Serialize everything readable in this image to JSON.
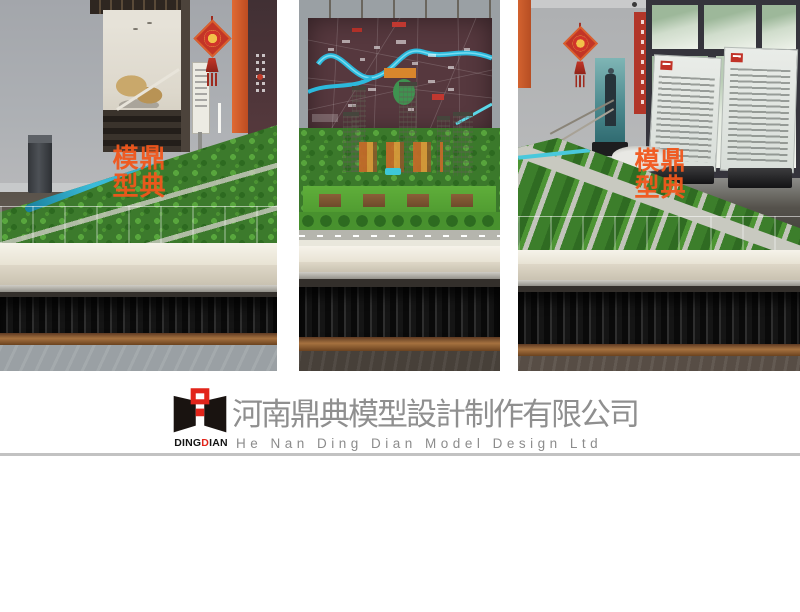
{
  "canvas": {
    "width": 800,
    "height": 612,
    "background": "#ffffff"
  },
  "branding": {
    "logo_word": {
      "part1": "DING",
      "accent": "D",
      "part2": "IAN"
    },
    "company_name_cn": "河南鼎典模型設計制作有限公司",
    "company_name_en": "He Nan Ding Dian Model Design Ltd",
    "accent_red": "#e2251b",
    "text_gray": "#8f8f8f",
    "divider_color": "#c2c2c2"
  },
  "watermark": {
    "color": "#f2571c",
    "chars": {
      "tl": "模",
      "tr": "鼎",
      "bl": "型",
      "br": "典"
    }
  },
  "photos": [
    {
      "name": "showroom-left",
      "alt": "scale model table beside staircase with chinese knot"
    },
    {
      "name": "showroom-center",
      "alt": "residential tower scale model in front of maroon district map"
    },
    {
      "name": "showroom-right",
      "alt": "scale model corner by windows with display boards"
    }
  ]
}
